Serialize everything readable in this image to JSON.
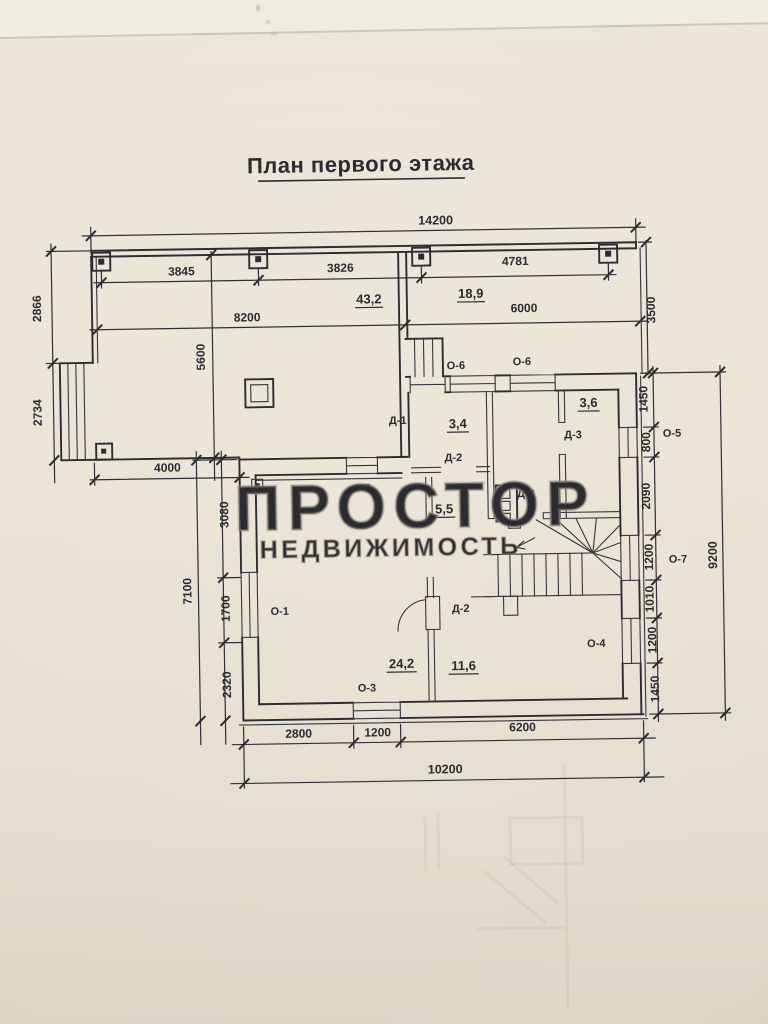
{
  "title": "План первого этажа",
  "watermark": {
    "brand": "ПРОСТОР",
    "sub": "НЕДВИЖИМОСТЬ"
  },
  "areas": {
    "terrace": "43,2",
    "veranda": "18,9",
    "hall": "3,4",
    "back_room": "3,6",
    "corridor": "5,5",
    "living_room": "24,2",
    "middle_room": "11,6"
  },
  "doors": {
    "d1": "Д-1",
    "d2": "Д-2",
    "d3": "Д-3"
  },
  "windows": {
    "o1": "О-1",
    "o3": "О-3",
    "o4": "О-4",
    "o5": "О-5",
    "o6": "О-6",
    "o7": "О-7"
  },
  "dims": {
    "top_overall": "14200",
    "col_spans": [
      "3845",
      "3826",
      "4781"
    ],
    "left_of_axis": "8200",
    "right_of_axis": "6000",
    "veranda_depth": "3500",
    "left_upper": "2866",
    "left_lower": "2734",
    "terrace_depth": "5600",
    "terrace_entry": "4000",
    "left_chain": [
      "3080",
      "1700",
      "2320"
    ],
    "left_overall": "7100",
    "right_chain": [
      "1450",
      "800",
      "2090",
      "1200",
      "1010",
      "1200",
      "1450"
    ],
    "right_overall": "9200",
    "bottom_chain": [
      "2800",
      "1200",
      "6200"
    ],
    "bottom_overall": "10200"
  }
}
